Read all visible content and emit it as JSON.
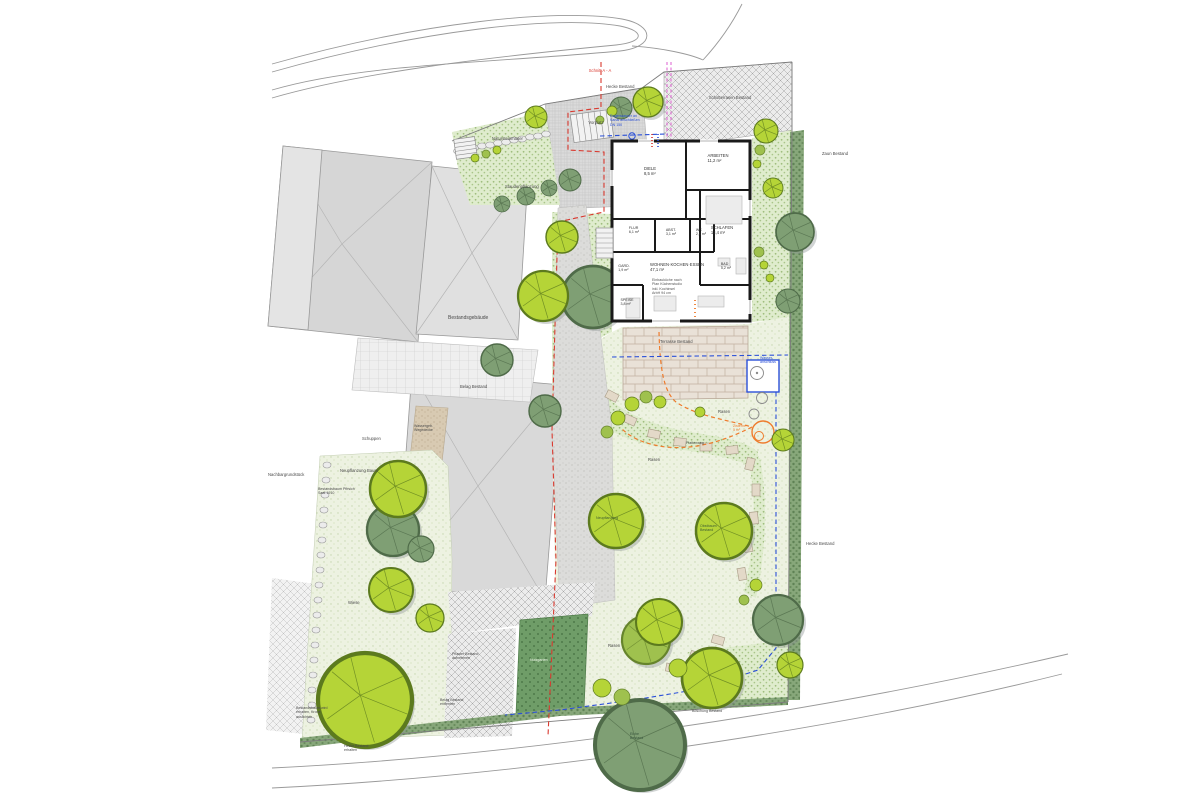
{
  "palette": {
    "page_bg": "#ffffff",
    "building_gray": "#d6d6d6",
    "lawn_green": "#edf2e1",
    "bed_green": "#dfeccd",
    "tree_new": "#b5d437",
    "tree_new_dark": "#5c7a1e",
    "tree_old": "#7f9f74",
    "tree_old_dark": "#4f6b49",
    "hedge_green": "#87a77a",
    "veg_green": "#6f9d68",
    "wall_black": "#1a1a1a",
    "accent_red": "#d9392f",
    "accent_blue": "#2b50d8",
    "accent_orange": "#ee7b2c",
    "accent_magenta": "#de5fd0",
    "paver_tan": "#e9e1d7",
    "gravel_tan": "#d8cab2"
  },
  "labels": {
    "schnitt_top": "Schnitt A - A",
    "hecke_top": "Hecke Bestand",
    "schotter": "Schotterrasen Bestand",
    "zaun_re_top": "Zaun Bestand",
    "hecke_re_mid": "Hecke Bestand",
    "vorplatz": "Vorplatz",
    "rw_note": "Regenwasser an\nKanal anschließen\nDN 150",
    "mauer": "Natursteinmauer",
    "stauden_top": "Staudenpflanzung",
    "bestandsgebaeude": "Bestandsgebäude",
    "belag_bestand": "Belag Bestand",
    "schuppen": "Schuppen",
    "nachbar": "Nachbargrundstück",
    "wegedecke": "Wassergeb.\nWegedecke",
    "neupflanzung_baum": "Neupflanzung Baum",
    "bestandsbaum_links": "Bestandsbaum Pfirsich\nSaat 1910",
    "wiese": "Wiese",
    "rasen1": "Rasen",
    "rasen2": "Rasen",
    "rasen3": "Rasen",
    "plattenweg": "Plattenweg",
    "terrasse": "Terrasse Bestand",
    "wasseranschluss": "Wasser-\nanschluss",
    "zisterne": "Zisterne\n5 m³",
    "pflaster_aufnehmen": "Pflaster Bestand\naufnehmen",
    "belag_entfernen": "Belag Bestand\nentfernen",
    "nutzgarten": "Nutzgarten",
    "boeschung": "Böschung Bestand",
    "eiche": "Eiche\nBestand",
    "bestandsbaum_unten": "Bestandsbaum wird\nerhalten, Krone\nauslichten",
    "hecke_unten": "Hecke Bestand\nerhalten",
    "obstbaum": "Obstbaum\nBestand",
    "neupflanzung2": "Neupflanzung"
  },
  "rooms": {
    "diele": "DIELE\n8,5 m²",
    "arbeiten": "ARBEITEN\n11,2 m²",
    "schlafen": "SCHLAFEN\n13,4 m²",
    "flur": "FLUR\n6,1 m²",
    "abstell": "ABST.\n3,1 m²",
    "wc": "WC\n2,1 m²",
    "bad": "BAD\n5,2 m²",
    "garderobe": "GARD.\n1,9 m²",
    "speise": "SPEISE\n3,8 m²",
    "wohnen": "WOHNEN·KOCHEN·ESSEN\n47,1 m²",
    "kuechen_note": "Einbauküche nach\nPlan Küchenstudio\ninkl. Kochinsel\nArbH 94 cm"
  }
}
